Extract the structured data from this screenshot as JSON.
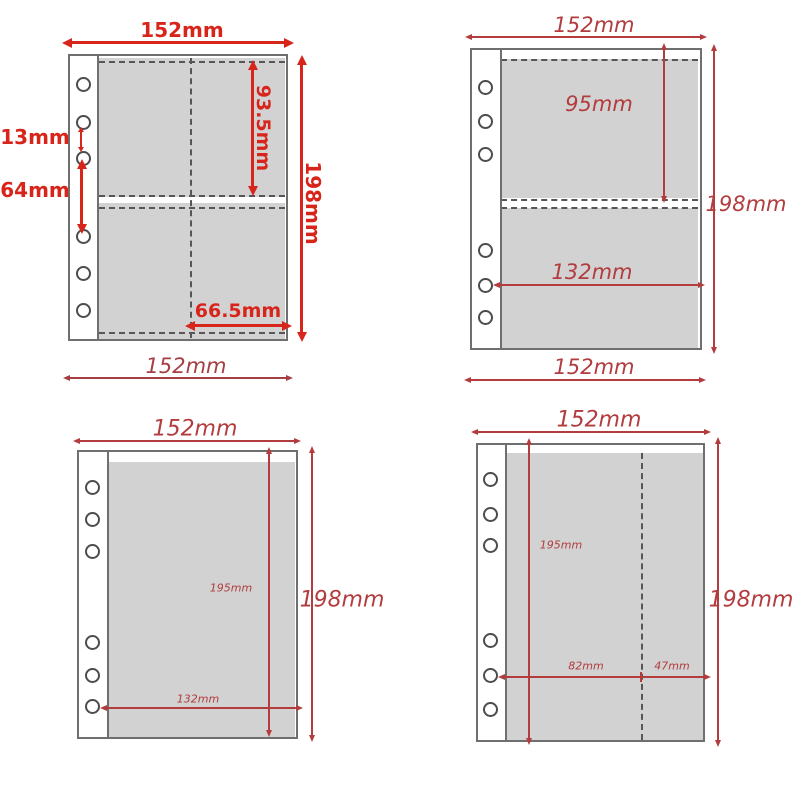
{
  "colors": {
    "accent_bold": "#d8251c",
    "accent_thin": "#b23c3e",
    "pocket_fill": "#d2d2d2",
    "page_outline": "#6f6f6f"
  },
  "diagrams": {
    "four_pocket": {
      "top_width": "152mm",
      "bottom_width": "152mm",
      "height": "198mm",
      "pocket_height": "93.5mm",
      "pocket_width": "66.5mm",
      "hole_gap_small": "13mm",
      "hole_gap_large": "64mm"
    },
    "two_pocket": {
      "top_width": "152mm",
      "bottom_width": "152mm",
      "height": "198mm",
      "pocket_height": "95mm",
      "pocket_width": "132mm"
    },
    "one_pocket": {
      "top_width": "152mm",
      "height": "198mm",
      "pocket_height": "195mm",
      "pocket_width": "132mm"
    },
    "split_pocket": {
      "top_width": "152mm",
      "height": "198mm",
      "pocket_height": "195mm",
      "left_width": "82mm",
      "right_width": "47mm"
    }
  }
}
